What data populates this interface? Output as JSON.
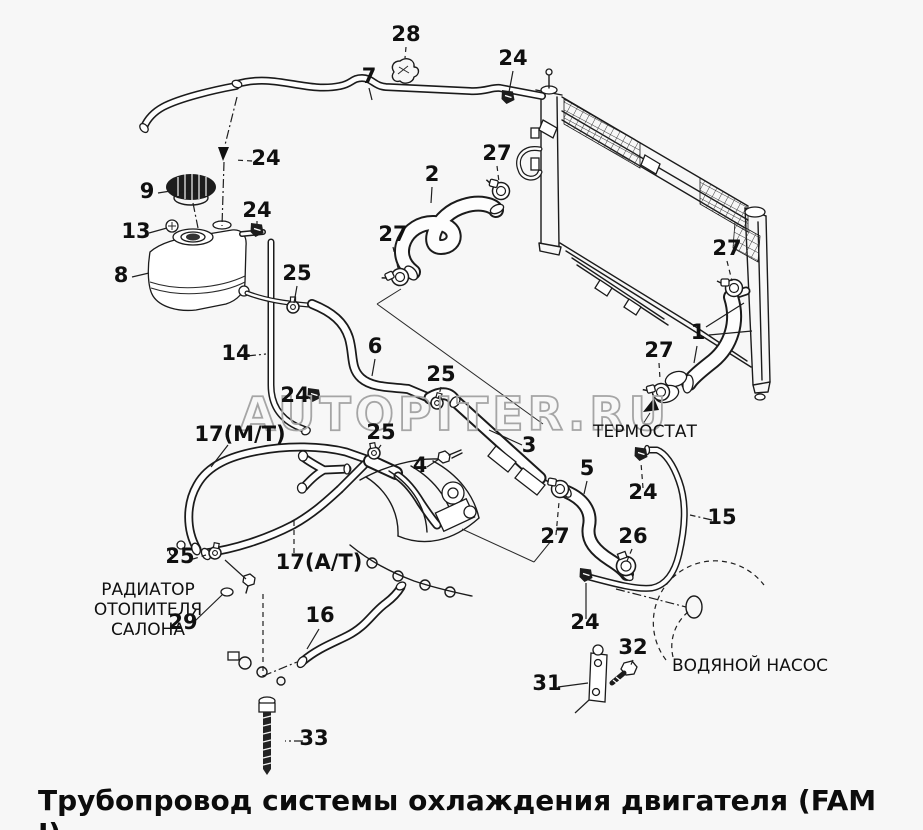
{
  "title": "Трубопровод системы охлаждения двигателя (FAM I)",
  "watermark": "AUTOPITER.RU",
  "labels": {
    "thermostat": "ТЕРМОСТАТ",
    "heater_line1": "РАДИАТОР",
    "heater_line2": "ОТОПИТЕЛЯ",
    "heater_line3": "САЛОНА",
    "water_pump": "ВОДЯНОЙ НАСОС"
  },
  "callouts": [
    {
      "text": "28"
    },
    {
      "text": "7"
    },
    {
      "text": "24"
    },
    {
      "text": "24"
    },
    {
      "text": "9"
    },
    {
      "text": "24"
    },
    {
      "text": "13"
    },
    {
      "text": "2"
    },
    {
      "text": "27"
    },
    {
      "text": "27"
    },
    {
      "text": "8"
    },
    {
      "text": "25"
    },
    {
      "text": "27"
    },
    {
      "text": "1"
    },
    {
      "text": "27"
    },
    {
      "text": "14"
    },
    {
      "text": "6"
    },
    {
      "text": "25"
    },
    {
      "text": "24"
    },
    {
      "text": "25"
    },
    {
      "text": "3"
    },
    {
      "text": "4"
    },
    {
      "text": "17(М/Т)"
    },
    {
      "text": "5"
    },
    {
      "text": "24"
    },
    {
      "text": "15"
    },
    {
      "text": "27"
    },
    {
      "text": "26"
    },
    {
      "text": "17(А/Т)"
    },
    {
      "text": "25"
    },
    {
      "text": "29"
    },
    {
      "text": "16"
    },
    {
      "text": "24"
    },
    {
      "text": "32"
    },
    {
      "text": "31"
    },
    {
      "text": "33"
    }
  ]
}
